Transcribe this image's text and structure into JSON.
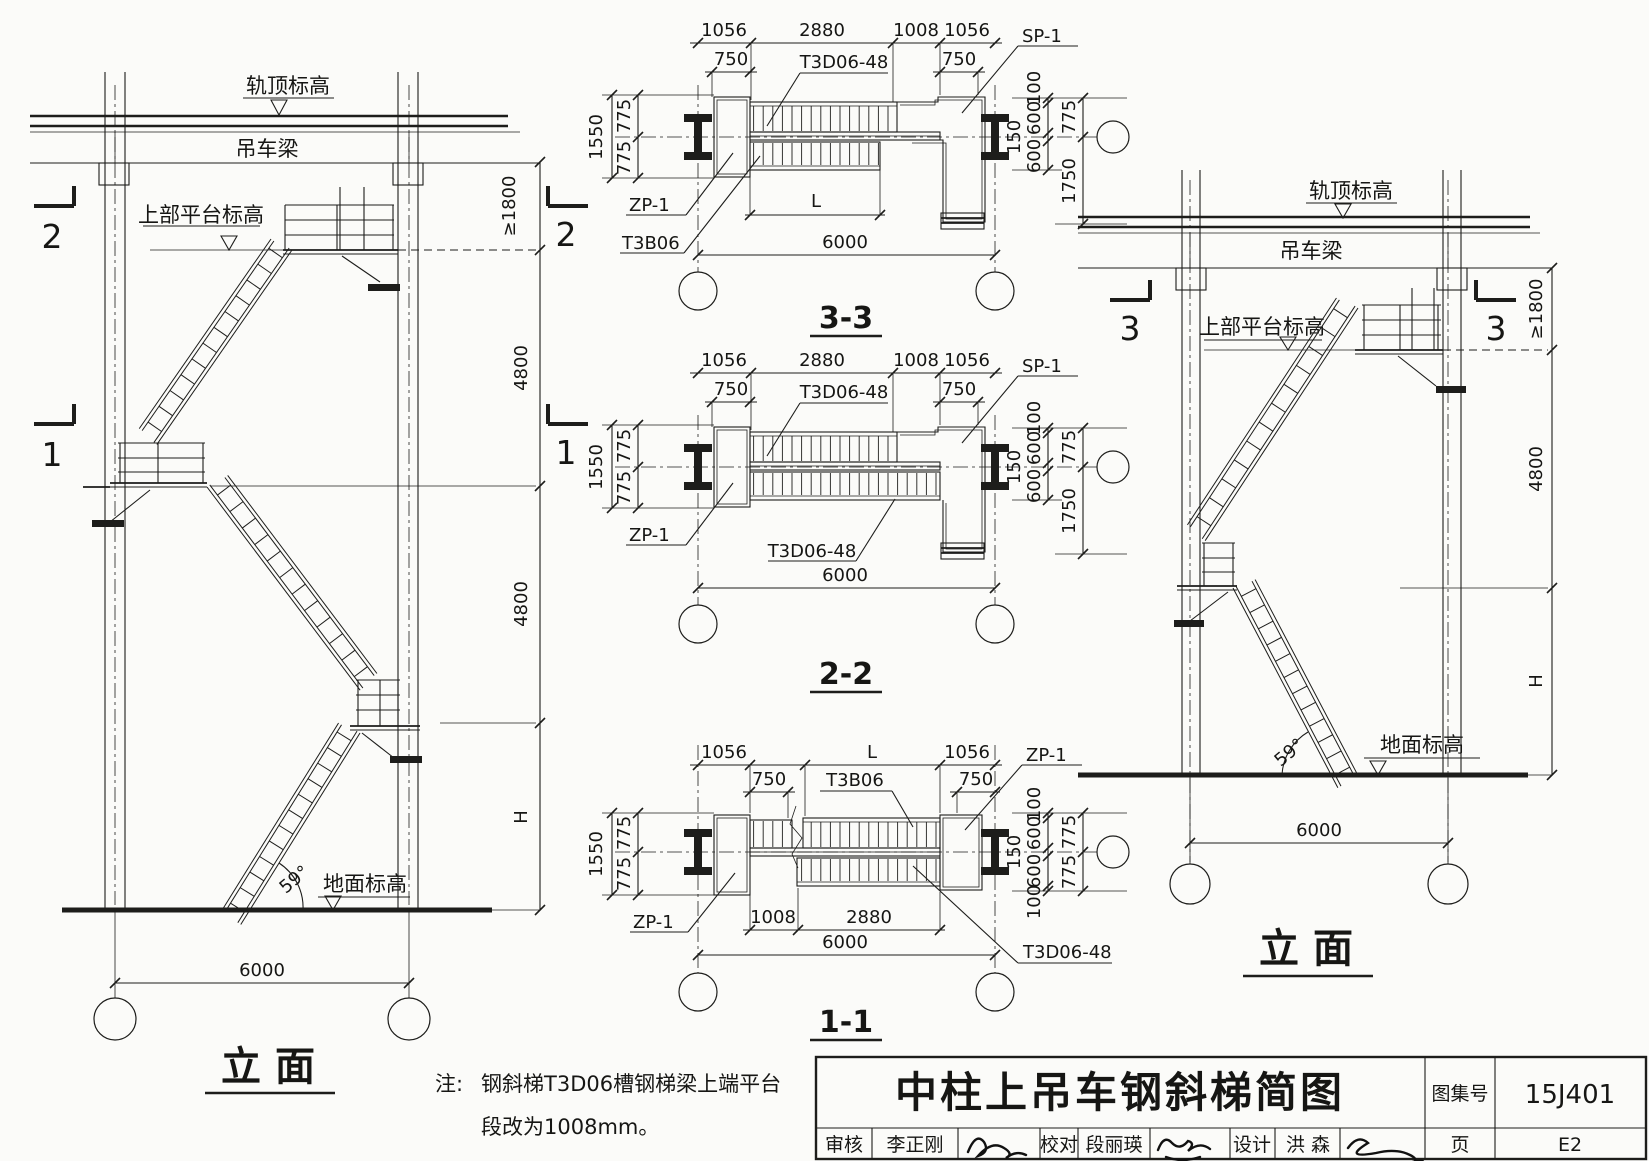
{
  "left_elevation": {
    "rail_top": "轨顶标高",
    "crane_beam": "吊车梁",
    "upper_platform": "上部平台标高",
    "ground": "地面标高",
    "angle": "59°",
    "dim_clearance": "≥1800",
    "dim_upper": "4800",
    "dim_lower": "4800",
    "dim_height": "H",
    "span": "6000",
    "marker_upper": "2",
    "marker_lower": "1",
    "title": "立 面"
  },
  "right_elevation": {
    "rail_top": "轨顶标高",
    "crane_beam": "吊车梁",
    "upper_platform": "上部平台标高",
    "ground": "地面标高",
    "angle": "59°",
    "dim_clearance": "≥1800",
    "dim_mid": "4800",
    "dim_height": "H",
    "span": "6000",
    "marker": "3",
    "title": "立 面"
  },
  "section_33": {
    "title": "3-3",
    "dim_1056": "1056",
    "dim_2880": "2880",
    "dim_1008": "1008",
    "dim_750": "750",
    "dim_1550": "1550",
    "dim_775": "775",
    "dim_100": "100",
    "dim_600": "600",
    "dim_150": "150",
    "dim_1750": "1750",
    "dim_L": "L",
    "span": "6000",
    "label_sp1": "SP-1",
    "label_t3d06": "T3D06-48",
    "label_zp1": "ZP-1",
    "label_t3b06": "T3B06"
  },
  "section_22": {
    "title": "2-2",
    "dim_1056": "1056",
    "dim_2880": "2880",
    "dim_1008": "1008",
    "dim_750": "750",
    "dim_1550": "1550",
    "dim_775": "775",
    "dim_100": "100",
    "dim_600": "600",
    "dim_150": "150",
    "dim_1750": "1750",
    "span": "6000",
    "label_sp1": "SP-1",
    "label_t3d06_top": "T3D06-48",
    "label_t3d06_bottom": "T3D06-48",
    "label_zp1": "ZP-1"
  },
  "section_11": {
    "title": "1-1",
    "dim_1056": "1056",
    "dim_L": "L",
    "dim_750": "750",
    "dim_1550": "1550",
    "dim_775": "775",
    "dim_100": "100",
    "dim_600": "600",
    "dim_150": "150",
    "dim_1008": "1008",
    "dim_2880": "2880",
    "span": "6000",
    "label_zp1_top": "ZP-1",
    "label_zp1_left": "ZP-1",
    "label_t3b06": "T3B06",
    "label_t3d06": "T3D06-48"
  },
  "note": {
    "prefix": "注:",
    "line1": "钢斜梯T3D06槽钢梯梁上端平台",
    "line2": "段改为1008mm。"
  },
  "title_block": {
    "main_title": "中柱上吊车钢斜梯简图",
    "atlas_label": "图集号",
    "atlas_no": "15J401",
    "page_label": "页",
    "page_no": "E2",
    "reviewer_label": "审核",
    "reviewer": "李正刚",
    "checker_label": "校对",
    "checker": "段丽瑛",
    "designer_label": "设计",
    "designer": "洪 森"
  }
}
